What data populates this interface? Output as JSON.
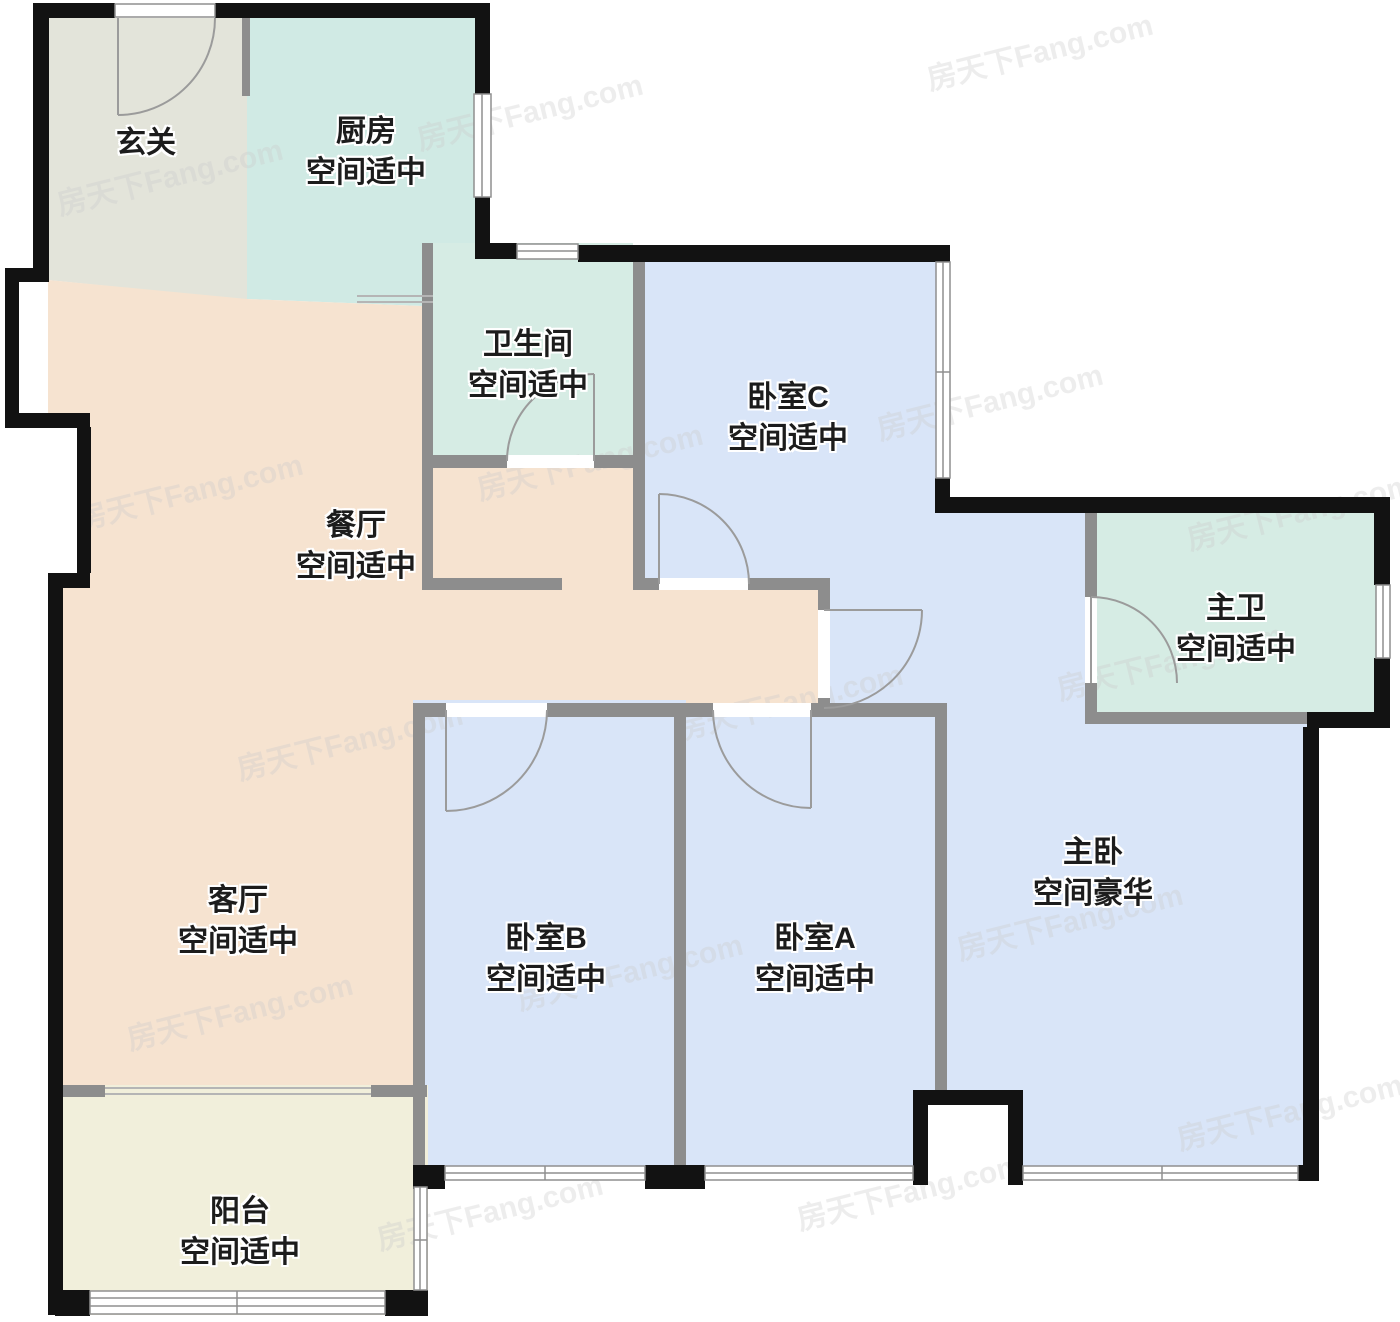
{
  "watermark": "房天下Fang.com",
  "palette": {
    "wall": "#121212",
    "interior_wall": "#8d8d8d",
    "door_arc": "#9b9b9b",
    "window_line": "#8f8f8f"
  },
  "rooms": [
    {
      "key": "entry",
      "name": "玄关",
      "status": "",
      "color": "#e3e4da",
      "label_x": 146,
      "label_y": 143
    },
    {
      "key": "kitchen",
      "name": "厨房",
      "status": "空间适中",
      "color": "#d0eae4",
      "label_x": 366,
      "label_y": 152
    },
    {
      "key": "bathroom",
      "name": "卫生间",
      "status": "空间适中",
      "color": "#d6ece4",
      "label_x": 528,
      "label_y": 365
    },
    {
      "key": "bedroom-c",
      "name": "卧室C",
      "status": "空间适中",
      "color": "#d9e5f8",
      "label_x": 788,
      "label_y": 418
    },
    {
      "key": "master-bathroom",
      "name": "主卫",
      "status": "空间适中",
      "color": "#d6ece4",
      "label_x": 1236,
      "label_y": 629
    },
    {
      "key": "dining",
      "name": "餐厅",
      "status": "空间适中",
      "color": "#f6e3d0",
      "label_x": 356,
      "label_y": 546
    },
    {
      "key": "living",
      "name": "客厅",
      "status": "空间适中",
      "color": "#f6e3d0",
      "label_x": 238,
      "label_y": 921
    },
    {
      "key": "bedroom-b",
      "name": "卧室B",
      "status": "空间适中",
      "color": "#d9e5f8",
      "label_x": 546,
      "label_y": 959
    },
    {
      "key": "bedroom-a",
      "name": "卧室A",
      "status": "空间适中",
      "color": "#d9e5f8",
      "label_x": 815,
      "label_y": 959
    },
    {
      "key": "master-bedroom",
      "name": "主卧",
      "status": "空间豪华",
      "color": "#d9e5f8",
      "label_x": 1093,
      "label_y": 873
    },
    {
      "key": "balcony",
      "name": "阳台",
      "status": "空间适中",
      "color": "#f1efdb",
      "label_x": 240,
      "label_y": 1232
    }
  ]
}
